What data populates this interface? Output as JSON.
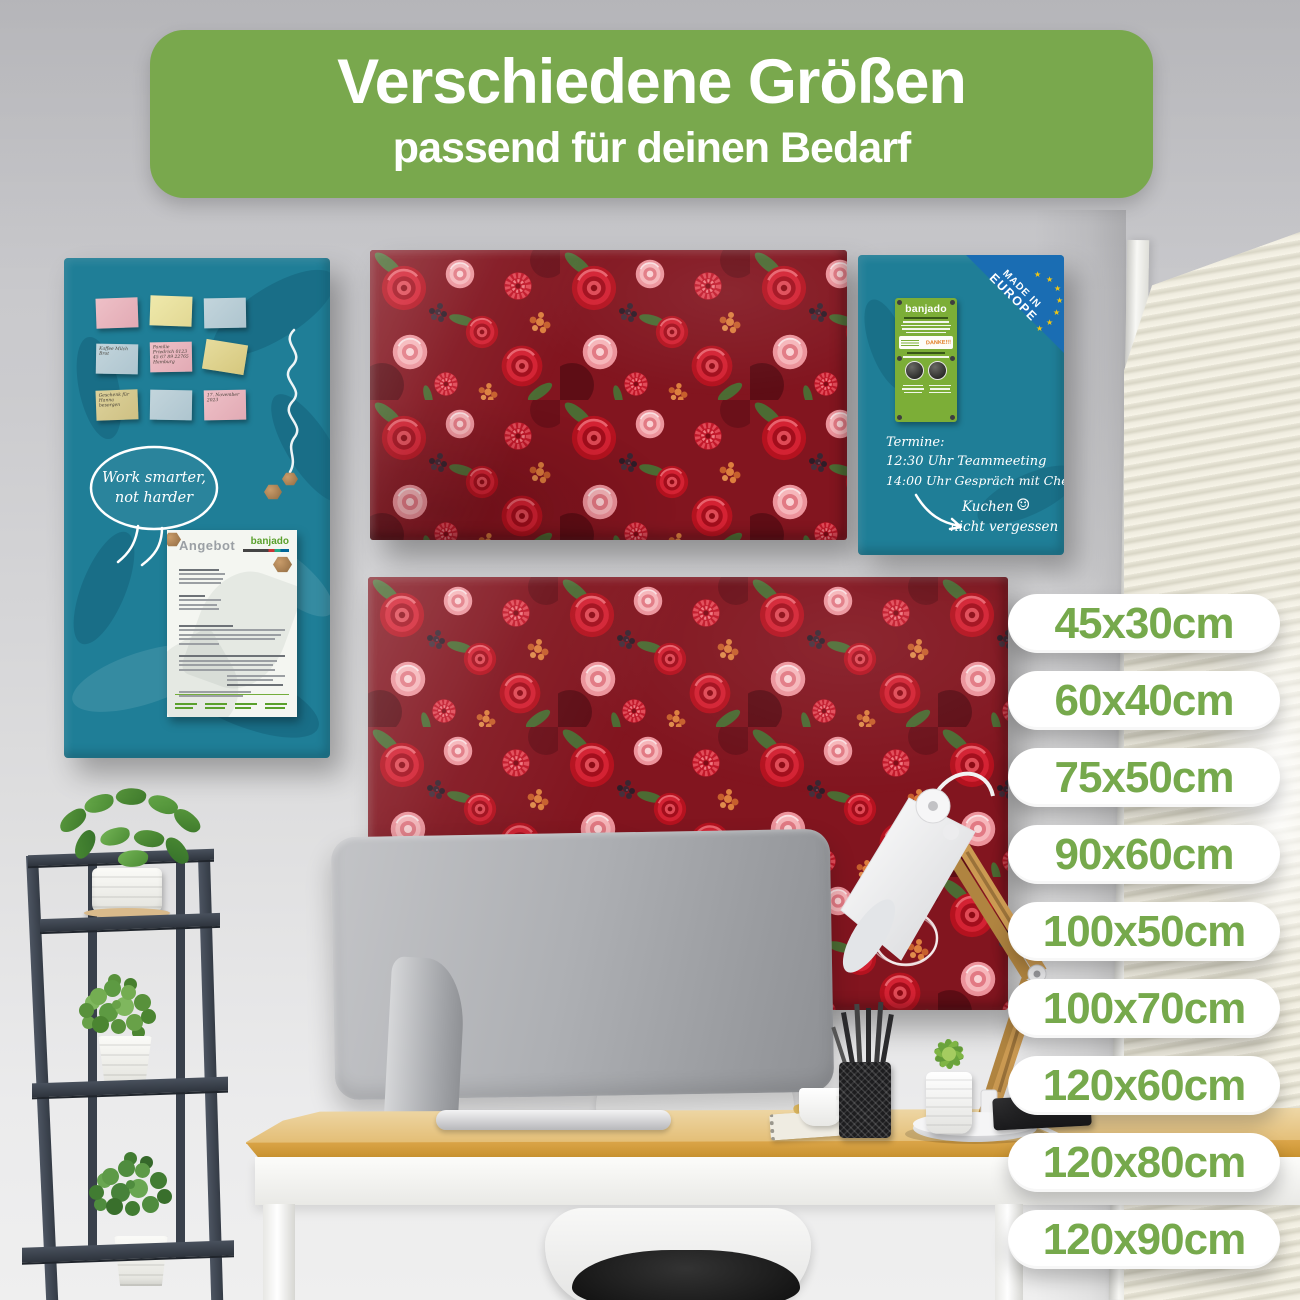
{
  "banner": {
    "title": "Verschiedene Größen",
    "subtitle": "passend für deinen Bedarf"
  },
  "sizes": [
    "45x30cm",
    "60x40cm",
    "75x50cm",
    "90x60cm",
    "100x50cm",
    "100x70cm",
    "120x60cm",
    "120x80cm",
    "120x90cm"
  ],
  "left_board": {
    "bubble": {
      "line1": "Work smarter,",
      "line2": "not harder"
    },
    "notes": [
      {
        "color": "pink",
        "text": ""
      },
      {
        "color": "yellow",
        "text": ""
      },
      {
        "color": "blue",
        "text": ""
      },
      {
        "color": "blue",
        "text": "Kaffee Milch Brot"
      },
      {
        "color": "pink",
        "text": "Familie Friedrich 0123 45 67 89 22765 Hamburg"
      },
      {
        "color": "yellow",
        "text": ""
      },
      {
        "color": "yellow",
        "text": "Geschenk für Hanna besorgen"
      },
      {
        "color": "blue",
        "text": ""
      },
      {
        "color": "pink",
        "text": "17. November 2023"
      }
    ],
    "doc": {
      "title": "Angebot",
      "brand": "banjado"
    }
  },
  "right_board": {
    "badge": {
      "line1": "MADE IN",
      "line2": "EUROPE",
      "star": "★"
    },
    "label": {
      "brand": "banjado",
      "thanks": "DANKE!!!"
    },
    "hand": {
      "line1": "Termine:",
      "line2": "12:30 Uhr Teammeeting",
      "line3": "14:00 Uhr Gespräch mit Chefin",
      "note1": "Kuchen",
      "note2": "nicht vergessen",
      "smiley": "☺"
    }
  },
  "colors": {
    "banner_green": "#79a84d",
    "pill_text_green": "#76a94c",
    "board_teal": "#1f7e97",
    "made_in_europe_blue": "#1a6db3",
    "label_green": "#7cae37",
    "flower_red": "#c2182a",
    "flower_pink": "#f0989f",
    "desk_wood": "#dca64a"
  }
}
